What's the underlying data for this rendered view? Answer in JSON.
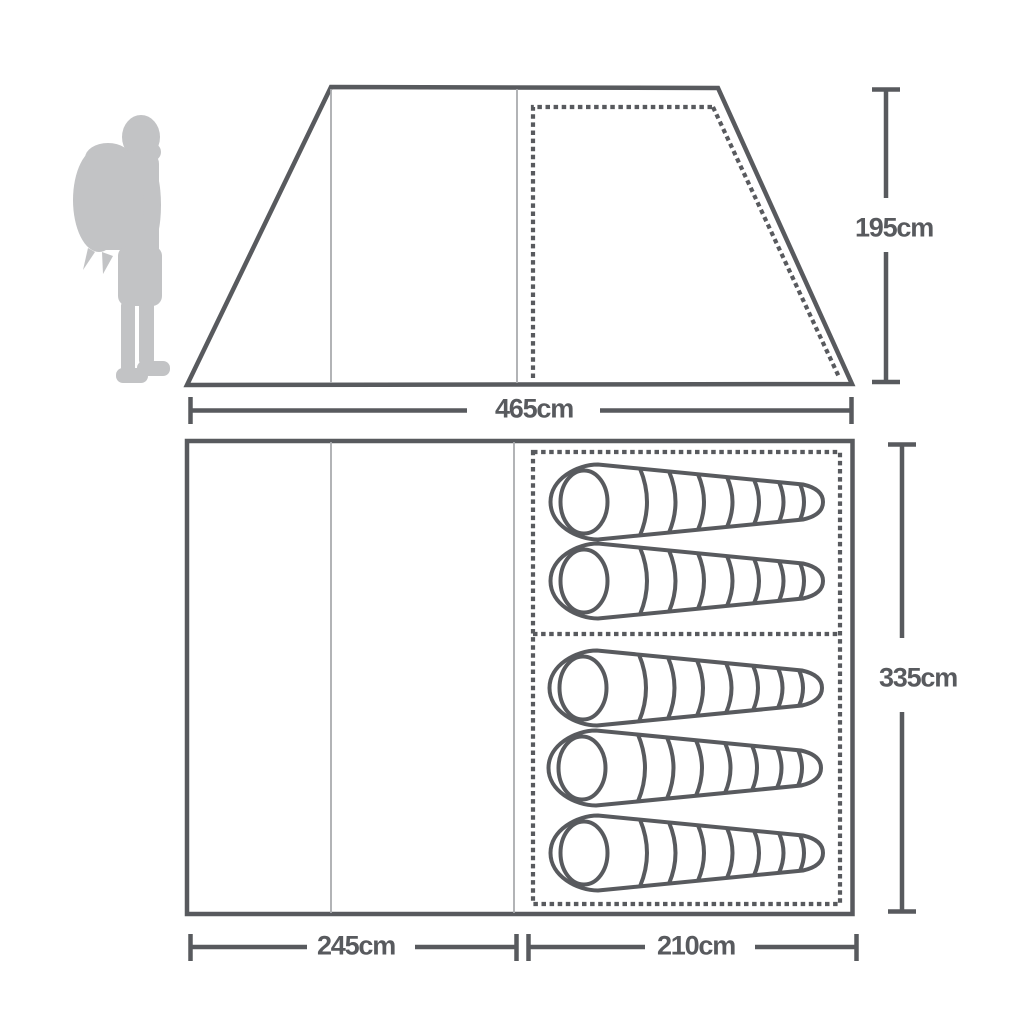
{
  "diagram": {
    "subject": "tent dimensions diagram",
    "side_elevation": {
      "height_label": "195cm",
      "base_width_label": "465cm",
      "inner_bedroom_outline": "dashed"
    },
    "floor_plan": {
      "depth_label": "335cm",
      "left_section_width_label": "245cm",
      "right_section_width_label": "210cm",
      "sleeping_bags_top_section": 2,
      "sleeping_bags_bottom_section": 3,
      "sleeping_bags_total": 5
    },
    "icons": {
      "scale_figure": "hiker-with-backpack-icon",
      "bed_symbol": "sleeping-bag-icon"
    },
    "colors": {
      "line": "#585a5e",
      "thin_line": "#a9abae",
      "figure_gray": "#c2c3c5",
      "background": "#ffffff"
    }
  }
}
